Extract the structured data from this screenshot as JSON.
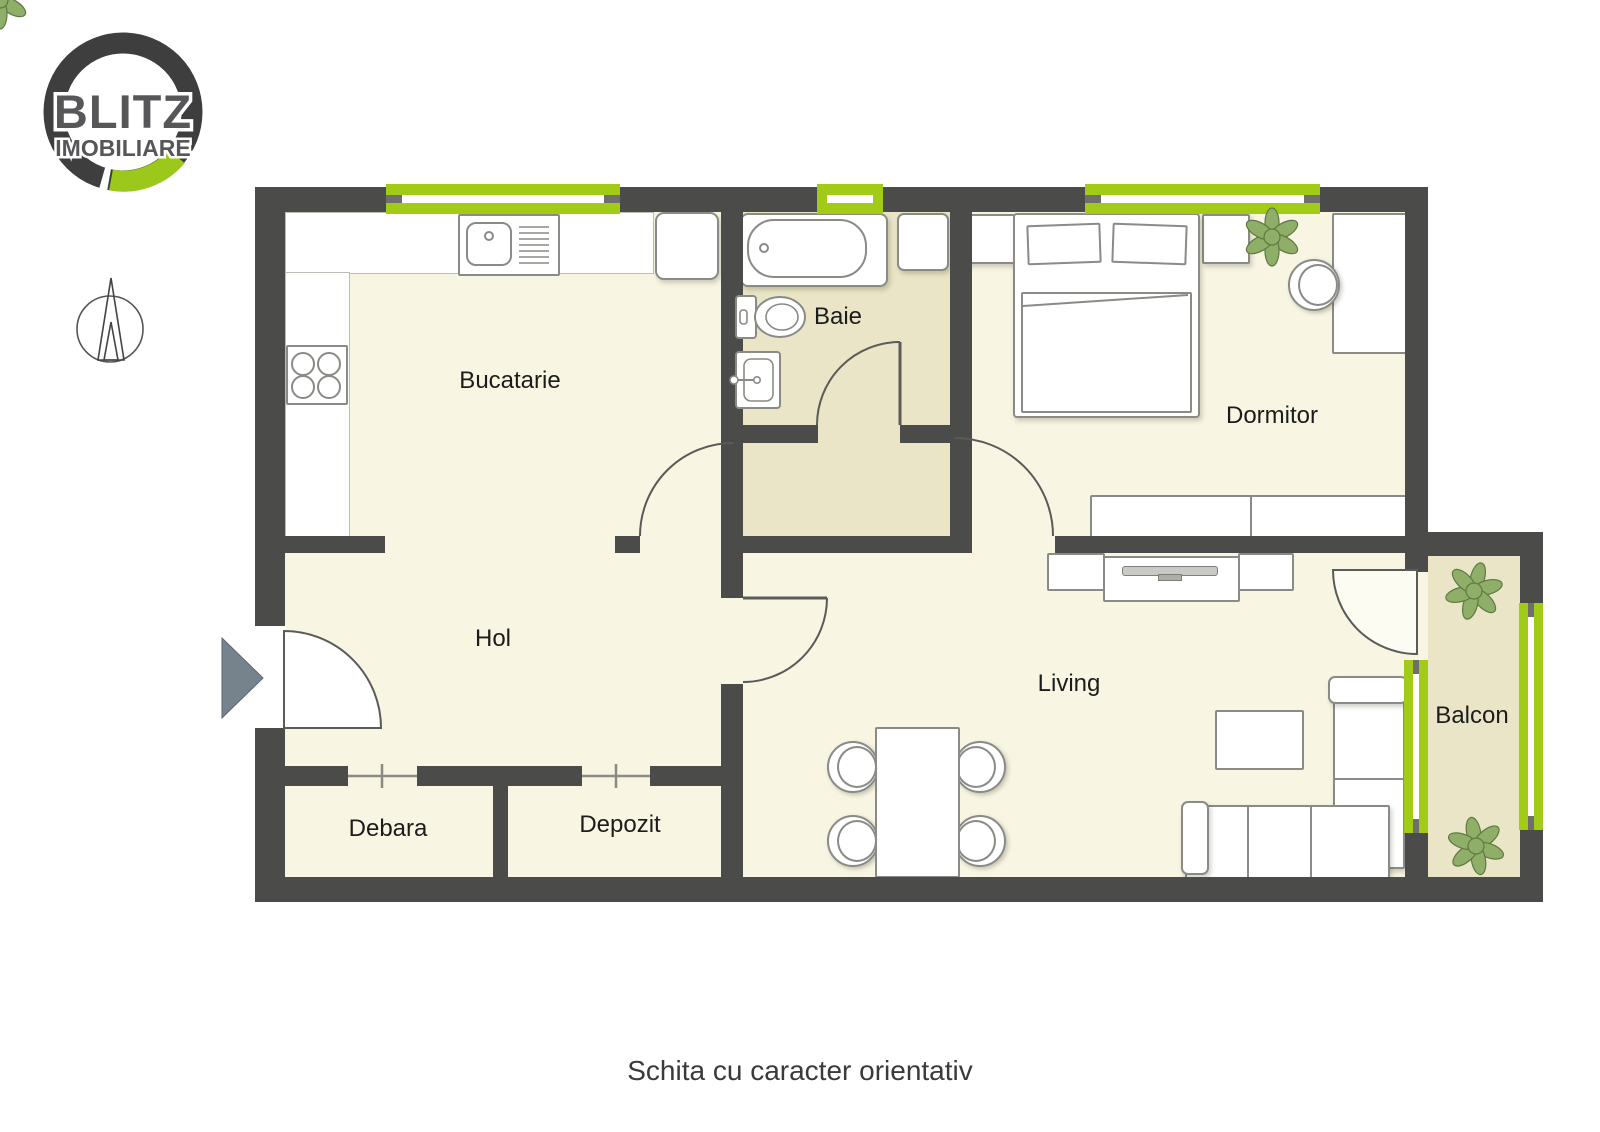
{
  "brand": {
    "name_line1": "BLITZ",
    "name_line2": "IMOBILIARE",
    "ring_dark": "#3E3E3E",
    "ring_green": "#9CC81C",
    "text_gray": "#57575A"
  },
  "rooms": {
    "bucatarie": "Bucatarie",
    "baie": "Baie",
    "dormitor": "Dormitor",
    "hol": "Hol",
    "debara": "Debara",
    "depozit": "Depozit",
    "living": "Living",
    "balcon": "Balcon"
  },
  "caption": "Schita cu caracter orientativ",
  "colors": {
    "wall": "#4B4B4A",
    "floor_dry": "#F8F5E2",
    "floor_wet": "#E9E5C6",
    "window_green": "#A2CB17",
    "entrance_arrow": "#76828C",
    "plant_green": "#8FAE68"
  },
  "icons": {
    "logo": "blitz-imobiliare-ring-logo",
    "compass": "north-arrow-compass",
    "entrance": "entrance-direction-arrow",
    "plant": "potted-plant"
  }
}
